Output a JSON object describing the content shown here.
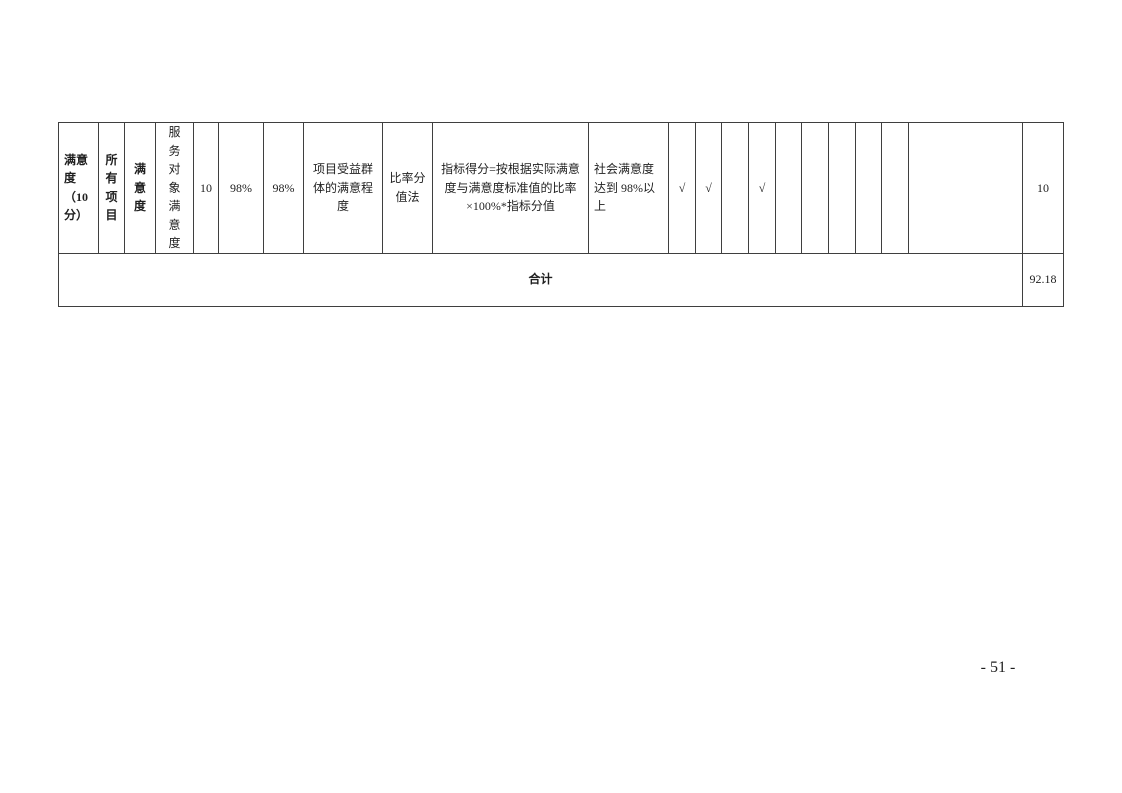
{
  "document": {
    "page_number": "- 51 -"
  },
  "table": {
    "header_row": {
      "satisfaction_category": "满意\n度\n（10\n分）",
      "all_projects": "所\n有\n项\n目",
      "satisfaction": "满\n意\n度",
      "service_object_satisfaction": "服\n务\n对\n象\n满\n意\n度",
      "indicator_score": "10",
      "standard_value": "98%",
      "actual_value": "98%",
      "indicator_explanation": "项目受益群\n体的满意程\n度",
      "scoring_method": "比率分\n值法",
      "scoring_formula": "指标得分=按根据实际满意\n度与满意度标准值的比率\n×100%*指标分值",
      "scoring_rule": "社会满意度\n达到 98%以\n上",
      "check_1": "√",
      "check_2": "√",
      "check_3": "",
      "check_4": "√",
      "check_5": "",
      "check_6": "",
      "check_7": "",
      "check_8": "",
      "check_9": "",
      "notes": "",
      "score": "10"
    },
    "total_row": {
      "label": "合计",
      "value": "92.18"
    }
  }
}
